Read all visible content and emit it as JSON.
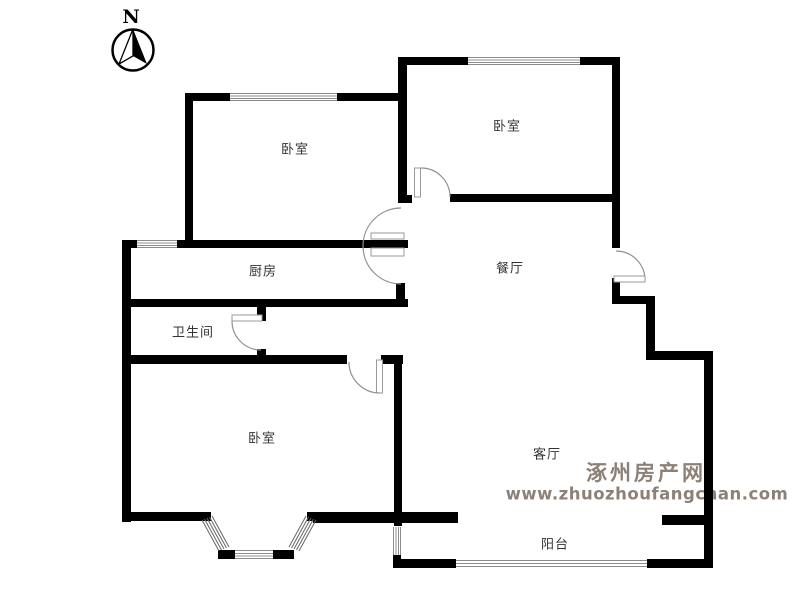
{
  "compass": {
    "label": "N"
  },
  "rooms": {
    "bedroom_top_left": {
      "label": "卧室"
    },
    "bedroom_top_right": {
      "label": "卧室"
    },
    "kitchen": {
      "label": "厨房"
    },
    "bathroom": {
      "label": "卫生间"
    },
    "dining": {
      "label": "餐厅"
    },
    "bedroom_bottom_left": {
      "label": "卧室"
    },
    "living": {
      "label": "客厅"
    },
    "balcony": {
      "label": "阳台"
    }
  },
  "watermark": {
    "site_name": "涿州房产网",
    "site_url": "www.zhuozhoufangchan.com",
    "color": "#8d8177"
  },
  "colors": {
    "wall": "#000000",
    "door_arc": "#909090",
    "window_line": "#8c8c8c",
    "label_text": "#333333",
    "background": "#ffffff"
  }
}
